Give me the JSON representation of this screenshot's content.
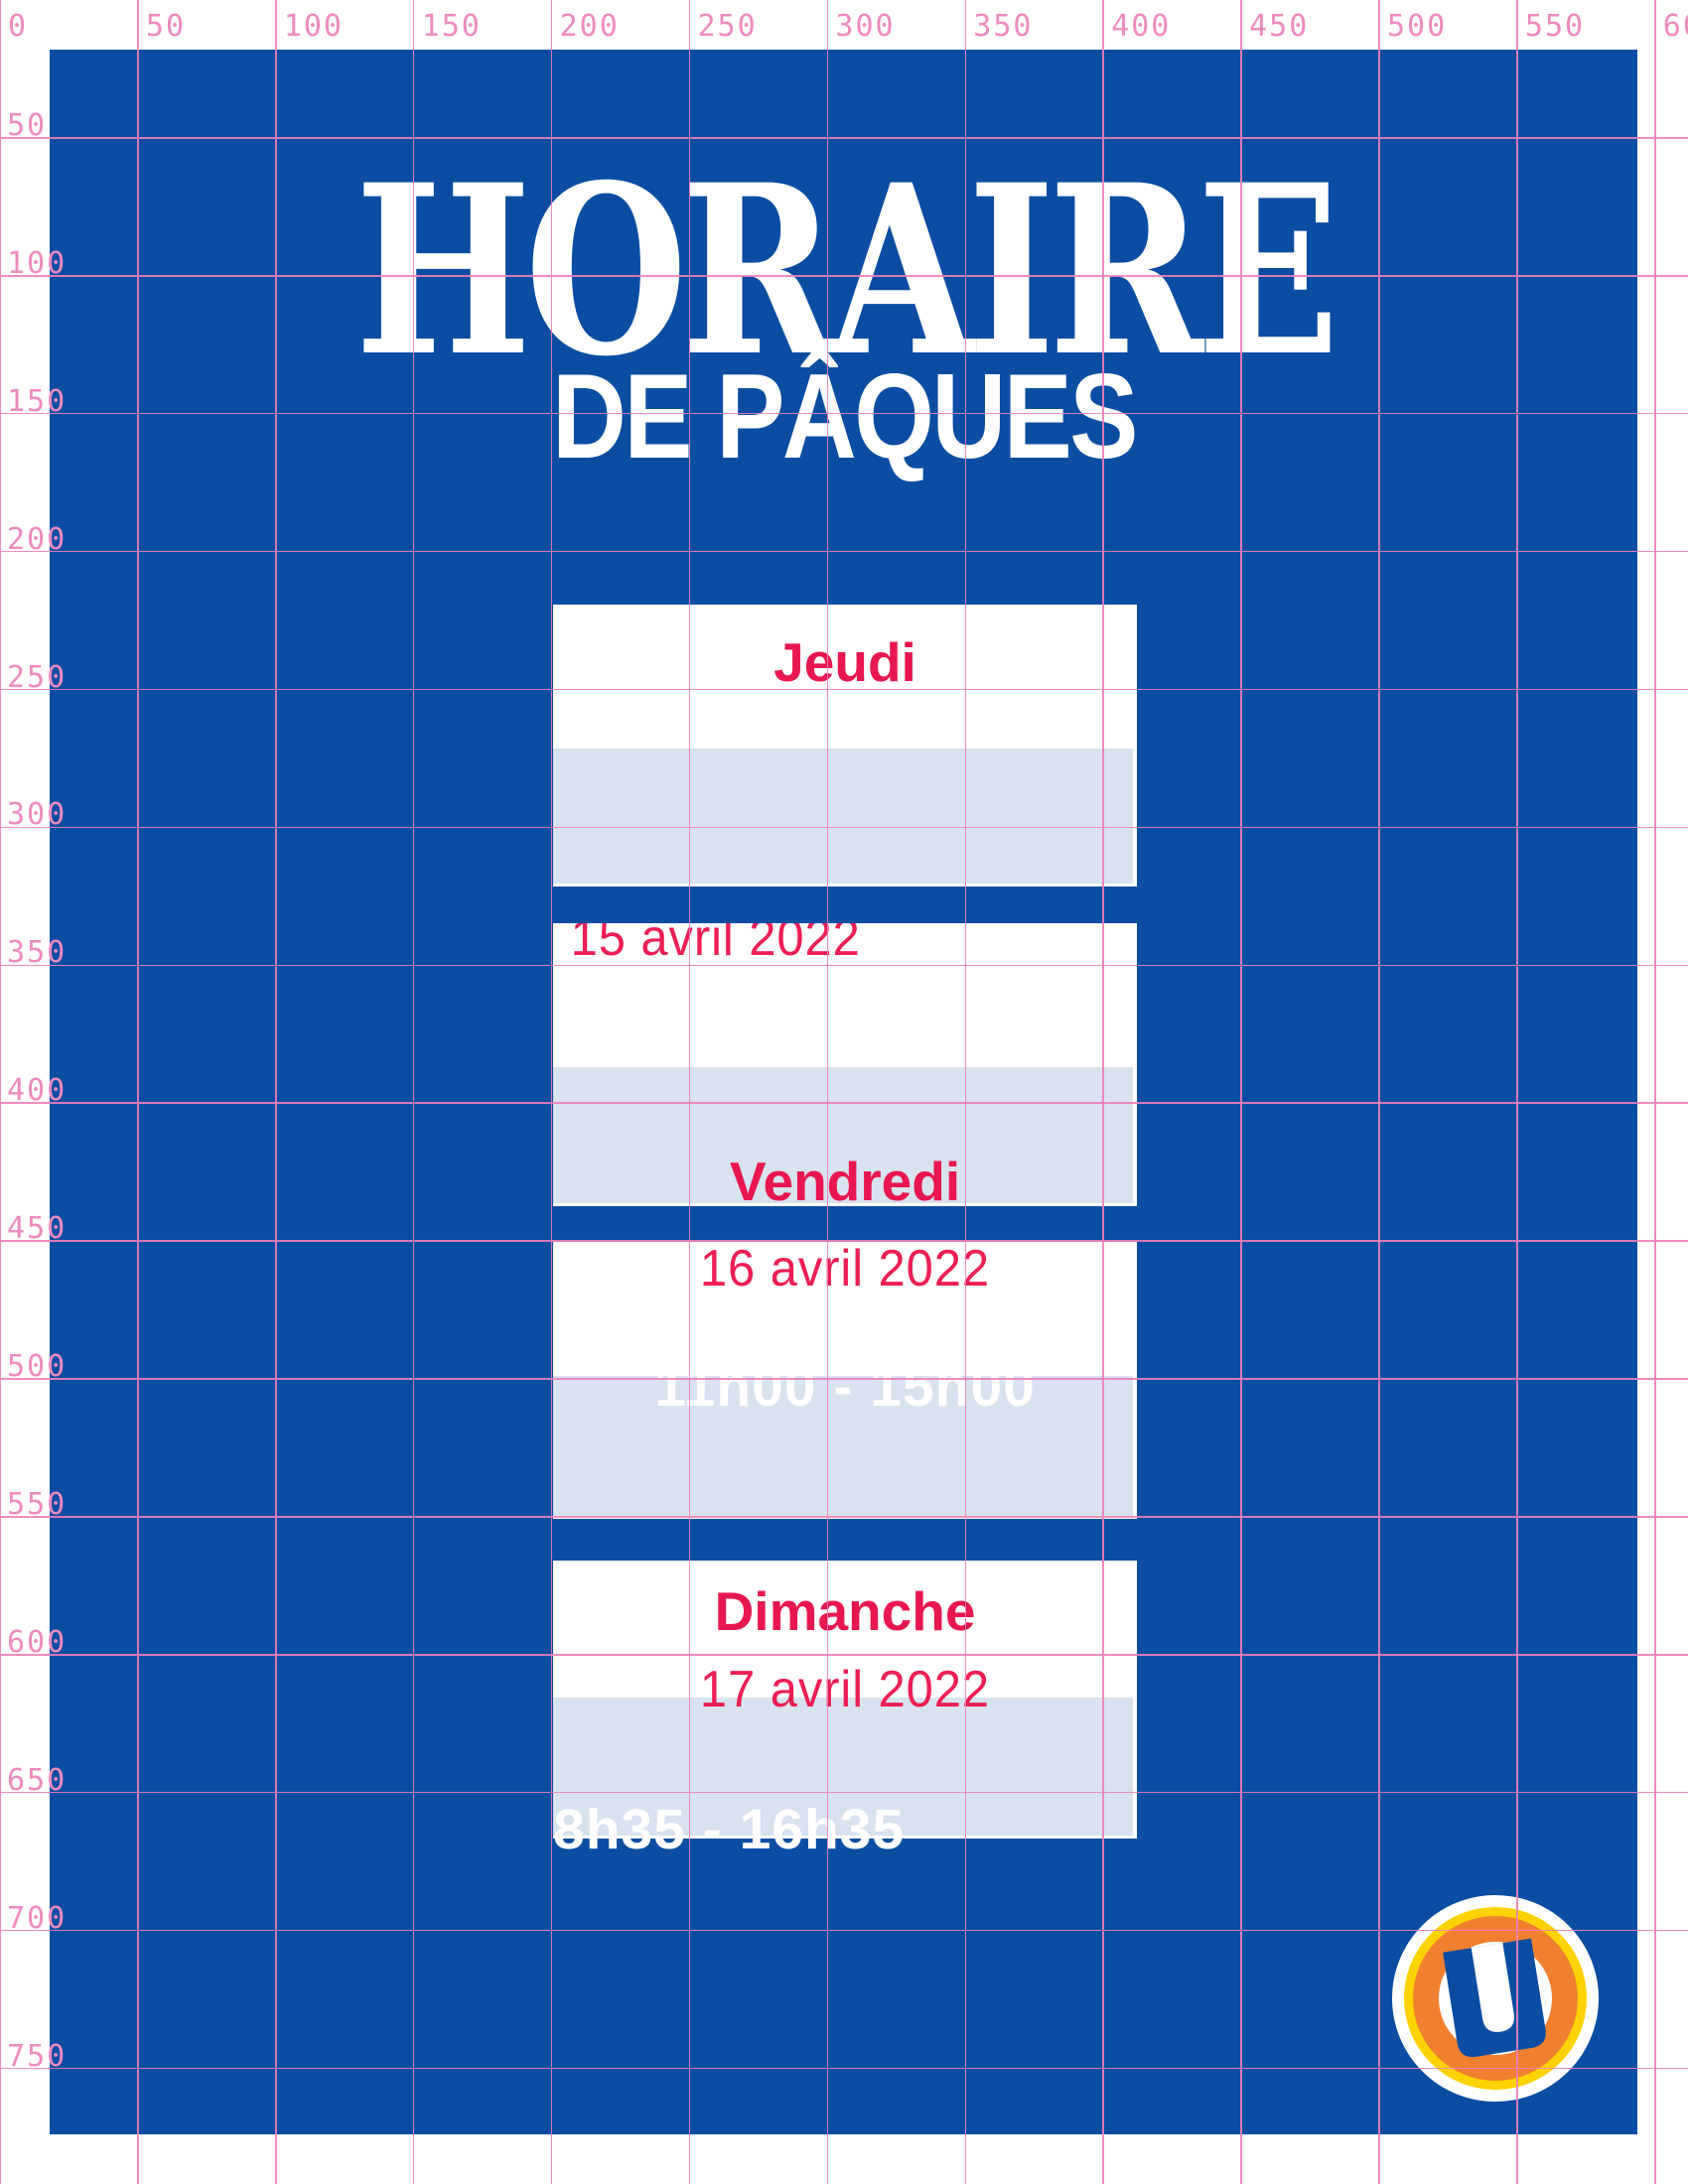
{
  "poster": {
    "title_line1": "HORAIRE",
    "title_line2": "DE PÂQUES"
  },
  "schedule": [
    {
      "day": "Jeudi",
      "date": "15 avril 2022",
      "time": ""
    },
    {
      "day": "Vendredi",
      "date": "16 avril 2022",
      "time": "11h00 - 15h00"
    },
    {
      "day": "Dimanche",
      "date": "17 avril 2022",
      "time": "8h35 - 16h35"
    }
  ],
  "ruler": {
    "top_labels": [
      "0",
      "50",
      "100",
      "150",
      "200",
      "250",
      "300",
      "350",
      "400",
      "450",
      "500",
      "550",
      "600"
    ],
    "left_labels": [
      "50",
      "100",
      "150",
      "200",
      "250",
      "300",
      "350",
      "400",
      "450",
      "500",
      "550",
      "600",
      "650",
      "700",
      "750"
    ]
  },
  "logo": {
    "letter": "U"
  },
  "colors": {
    "poster_blue": "#0b4da2",
    "band_light_blue": "#d9e2ef",
    "day_red": "#e8174f",
    "date_pink": "#ec1e54",
    "grid_pink": "#ee7eb9",
    "logo_yellow": "#ffd200",
    "logo_orange": "#f08030",
    "white": "#ffffff"
  }
}
